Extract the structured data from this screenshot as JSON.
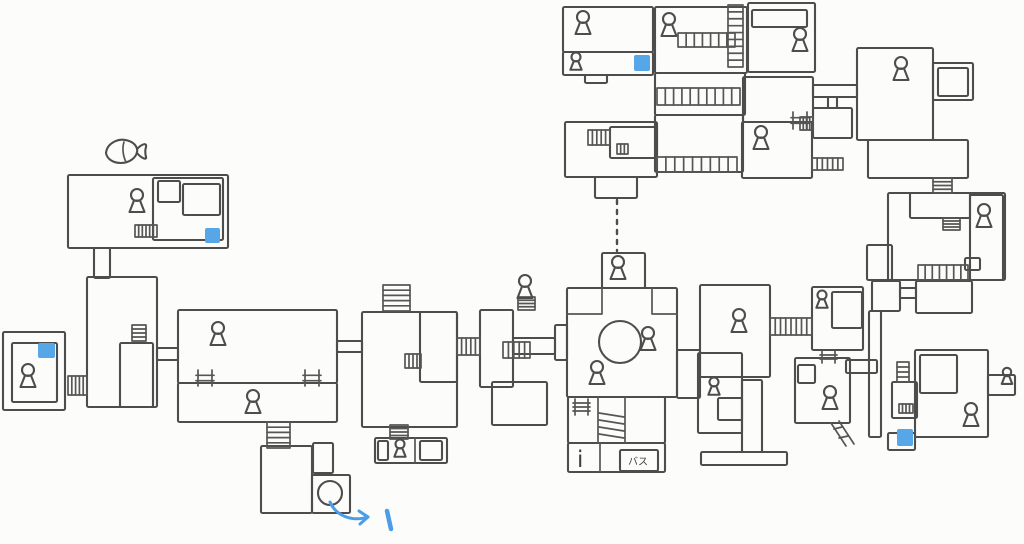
{
  "labels": {
    "info_booth": "i",
    "bus_stop": "バス",
    "route_mark": "1"
  },
  "palette": {
    "ink": "#4d4d4d",
    "paper": "#fcfcfb",
    "marker_blue": "#57a6e8",
    "arrow_blue": "#4a9de8"
  },
  "map": {
    "canvas": {
      "width": 1024,
      "height": 544
    },
    "rooms": [
      [
        68,
        175,
        160,
        73
      ],
      [
        153,
        178,
        70,
        62
      ],
      [
        183,
        184,
        37,
        31
      ],
      [
        158,
        181,
        22,
        21
      ],
      [
        94,
        248,
        16,
        30
      ],
      [
        87,
        277,
        70,
        130
      ],
      [
        120,
        343,
        33,
        64
      ],
      [
        3,
        332,
        62,
        78
      ],
      [
        12,
        343,
        45,
        59
      ],
      [
        157,
        348,
        21,
        12
      ],
      [
        178,
        310,
        159,
        73
      ],
      [
        178,
        383,
        159,
        39
      ],
      [
        337,
        341,
        25,
        11
      ],
      [
        362,
        312,
        95,
        115
      ],
      [
        420,
        312,
        37,
        70
      ],
      [
        261,
        446,
        51,
        67
      ],
      [
        312,
        475,
        38,
        38
      ],
      [
        313,
        443,
        20,
        30
      ],
      [
        375,
        438,
        72,
        25
      ],
      [
        378,
        441,
        10,
        19
      ],
      [
        420,
        441,
        22,
        19
      ],
      [
        480,
        310,
        33,
        77
      ],
      [
        492,
        382,
        55,
        43
      ],
      [
        513,
        338,
        42,
        16
      ],
      [
        555,
        325,
        12,
        35
      ],
      [
        567,
        288,
        110,
        109
      ],
      [
        602,
        253,
        43,
        35
      ],
      [
        677,
        350,
        23,
        48
      ],
      [
        568,
        397,
        97,
        46
      ],
      [
        568,
        443,
        97,
        29
      ],
      [
        620,
        450,
        38,
        21
      ],
      [
        700,
        285,
        70,
        92
      ],
      [
        812,
        287,
        51,
        63
      ],
      [
        832,
        292,
        30,
        36
      ],
      [
        698,
        353,
        44,
        80
      ],
      [
        718,
        398,
        24,
        22
      ],
      [
        742,
        380,
        20,
        72
      ],
      [
        701,
        452,
        86,
        13
      ],
      [
        795,
        358,
        55,
        65
      ],
      [
        798,
        365,
        17,
        18
      ],
      [
        846,
        360,
        31,
        13
      ],
      [
        872,
        281,
        28,
        30
      ],
      [
        900,
        288,
        16,
        10
      ],
      [
        916,
        281,
        56,
        32
      ],
      [
        869,
        311,
        12,
        126
      ],
      [
        892,
        382,
        25,
        36
      ],
      [
        915,
        350,
        73,
        87
      ],
      [
        920,
        355,
        37,
        38
      ],
      [
        888,
        433,
        27,
        17
      ],
      [
        988,
        375,
        27,
        20
      ],
      [
        888,
        193,
        117,
        87
      ],
      [
        867,
        245,
        25,
        35
      ],
      [
        910,
        193,
        60,
        25
      ],
      [
        970,
        195,
        33,
        85
      ],
      [
        748,
        3,
        67,
        69
      ],
      [
        752,
        10,
        55,
        17
      ],
      [
        743,
        77,
        70,
        45
      ],
      [
        857,
        48,
        76,
        92
      ],
      [
        933,
        63,
        40,
        37
      ],
      [
        938,
        68,
        30,
        28
      ],
      [
        868,
        140,
        100,
        38
      ],
      [
        813,
        85,
        44,
        12
      ],
      [
        828,
        97,
        9,
        11
      ],
      [
        813,
        108,
        39,
        30
      ],
      [
        563,
        7,
        90,
        45
      ],
      [
        563,
        52,
        90,
        23
      ],
      [
        585,
        75,
        22,
        8
      ],
      [
        655,
        7,
        92,
        66
      ],
      [
        655,
        73,
        90,
        42
      ],
      [
        655,
        115,
        88,
        57
      ],
      [
        565,
        122,
        92,
        55
      ],
      [
        610,
        127,
        47,
        31
      ],
      [
        595,
        177,
        42,
        21
      ],
      [
        742,
        122,
        70,
        56
      ],
      [
        965,
        258,
        15,
        12
      ]
    ],
    "band_corridors": [
      [
        68,
        376,
        19,
        19,
        "h",
        4
      ],
      [
        457,
        338,
        23,
        17,
        "h",
        4
      ],
      [
        503,
        342,
        27,
        16,
        "h",
        4
      ],
      [
        770,
        318,
        42,
        17,
        "h",
        7
      ],
      [
        918,
        265,
        50,
        15,
        "h",
        6
      ],
      [
        812,
        158,
        31,
        12,
        "h",
        5
      ],
      [
        678,
        33,
        57,
        14,
        "h",
        6
      ],
      [
        657,
        88,
        83,
        17,
        "h",
        9
      ],
      [
        657,
        157,
        80,
        15,
        "h",
        8
      ],
      [
        135,
        225,
        22,
        12,
        "h",
        5
      ],
      [
        588,
        130,
        22,
        15,
        "h",
        4
      ],
      [
        800,
        117,
        13,
        13,
        "h",
        3
      ],
      [
        405,
        354,
        16,
        14,
        "h",
        3
      ],
      [
        899,
        404,
        14,
        9,
        "h",
        3
      ],
      [
        617,
        144,
        11,
        10,
        "h",
        2
      ],
      [
        267,
        422,
        23,
        26,
        "v",
        4
      ],
      [
        383,
        285,
        27,
        26,
        "v",
        4
      ],
      [
        390,
        425,
        18,
        14,
        "v",
        3
      ],
      [
        518,
        297,
        17,
        13,
        "v",
        3
      ],
      [
        728,
        5,
        15,
        62,
        "v",
        8
      ],
      [
        933,
        178,
        19,
        15,
        "v",
        3
      ],
      [
        897,
        362,
        12,
        20,
        "v",
        3
      ],
      [
        132,
        325,
        14,
        16,
        "v",
        3
      ],
      [
        943,
        218,
        17,
        12,
        "v",
        3
      ]
    ],
    "ladder_icons": [
      [
        198,
        370,
        14,
        16,
        2
      ],
      [
        305,
        370,
        14,
        16,
        2
      ],
      [
        822,
        351,
        13,
        12,
        2
      ],
      [
        793,
        112,
        14,
        17,
        2
      ],
      [
        575,
        399,
        13,
        16,
        3
      ]
    ],
    "npcs": [
      [
        137,
        195,
        1
      ],
      [
        28,
        370,
        1
      ],
      [
        218,
        328,
        1
      ],
      [
        253,
        396,
        1
      ],
      [
        400,
        444,
        0.75
      ],
      [
        525,
        281,
        1
      ],
      [
        618,
        262,
        1
      ],
      [
        648,
        333,
        1
      ],
      [
        597,
        367,
        1
      ],
      [
        739,
        315,
        1
      ],
      [
        822,
        295,
        0.75
      ],
      [
        714,
        382,
        0.75
      ],
      [
        830,
        392,
        1
      ],
      [
        971,
        409,
        1
      ],
      [
        1007,
        372,
        0.7
      ],
      [
        984,
        210,
        1
      ],
      [
        800,
        34,
        1
      ],
      [
        901,
        63,
        1
      ],
      [
        583,
        17,
        1
      ],
      [
        576,
        57,
        0.75
      ],
      [
        669,
        19,
        1
      ],
      [
        761,
        132,
        1
      ]
    ],
    "item_markers": [
      [
        205,
        228,
        15,
        15
      ],
      [
        38,
        343,
        17,
        15
      ],
      [
        634,
        55,
        16,
        16
      ],
      [
        897,
        429,
        16,
        17
      ]
    ],
    "circles": [
      {
        "cx": 620,
        "cy": 342,
        "r": 21,
        "name": "fountain-circle"
      },
      {
        "cx": 330,
        "cy": 493,
        "r": 12,
        "name": "pit-circle"
      }
    ],
    "wall_details": [
      "M602,288 L602,314 L567,314",
      "M652,288 L652,314 L677,314",
      "M598,397 L598,443",
      "M625,397 L625,443",
      "M600,443 L600,472",
      "M415,438 L415,463",
      "M599,413 L624,417",
      "M599,420 L624,424",
      "M599,427 L624,431",
      "M599,434 L624,438",
      "M831,423 L846,446",
      "M839,421 L854,444",
      "M834,429 L842,427",
      "M839,438 L848,436"
    ],
    "fish": {
      "body": "M106,153 C107,143 119,137 129,141 C135,143 138,148 137,152 C136,158 129,163 121,163 C113,163 107,159 106,153 Z",
      "tail": "M137,149 C143,143 147,143 146,147 C145,150 145,153 146,157 C147,160 142,159 137,153",
      "fin": "M124,142 C122,148 123,156 126,162"
    },
    "hidden_links": [
      [
        617,
        200,
        617,
        251
      ]
    ],
    "texts": [
      {
        "x": 577,
        "y": 467,
        "key": "info_booth",
        "size": 23,
        "name": "info-label"
      },
      {
        "x": 628,
        "y": 465,
        "key": "bus_stop",
        "size": 10,
        "name": "bus-label"
      }
    ],
    "arrow": {
      "curve": "M330,502 C336,516 352,522 368,517",
      "head": "M368,517 L359,511 M368,517 L360,524",
      "mark": "M387,511 L391,529"
    }
  }
}
